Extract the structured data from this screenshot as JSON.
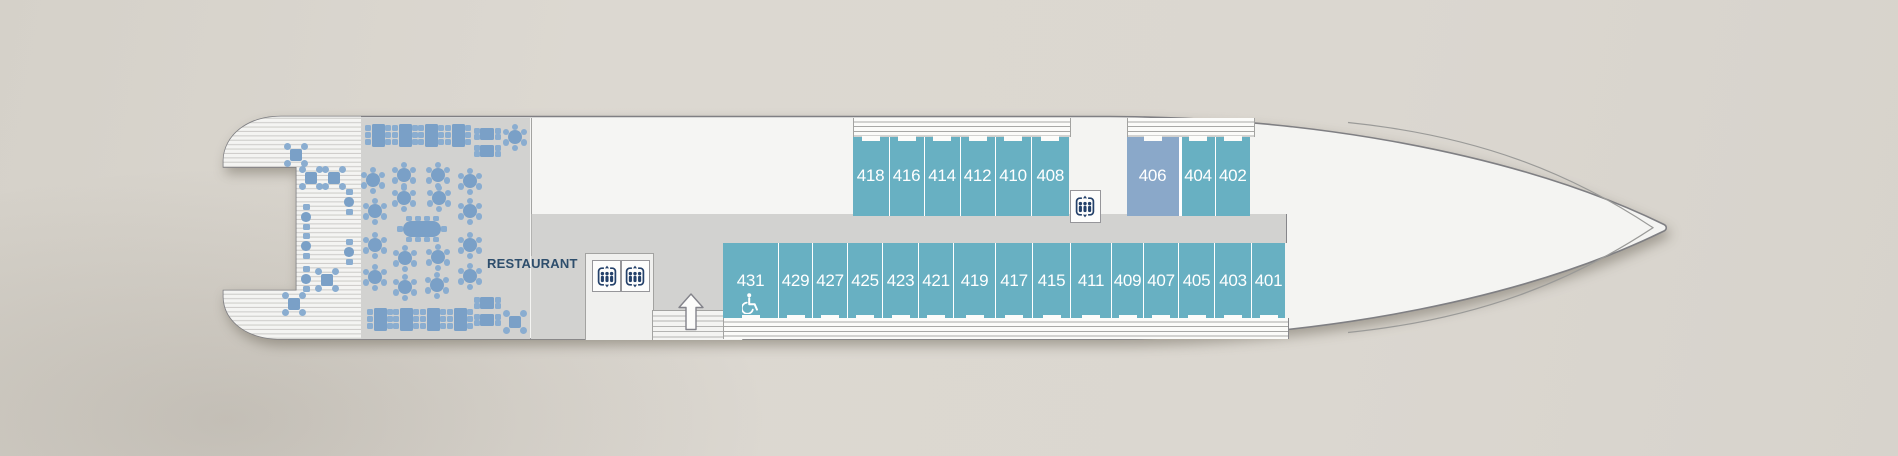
{
  "labels": {
    "restaurant": "RESTAURANT"
  },
  "colors": {
    "background": "#dad6cf",
    "hull_white": "#f4f4f2",
    "hull_outline": "#7f7f83",
    "floor_gray": "#d2d2d0",
    "cabin_teal": "#68b0c2",
    "cabin_blue": "#8aa8c9",
    "table_blue": "#7aa0c7",
    "chair_blue": "#8aadd0",
    "label_navy": "#2e4e6c",
    "icon_navy": "#24416a"
  },
  "icons": [
    {
      "name": "elevator-icon",
      "count": 3
    },
    {
      "name": "wheelchair-icon",
      "count": 1
    },
    {
      "name": "up-arrow-icon",
      "count": 1
    }
  ],
  "cabins": {
    "top_aft_row": [
      {
        "number": "418",
        "w": 36
      },
      {
        "number": "416",
        "w": 35
      },
      {
        "number": "414",
        "w": 36
      },
      {
        "number": "412",
        "w": 35
      },
      {
        "number": "410",
        "w": 36
      },
      {
        "number": "408",
        "w": 38.5
      }
    ],
    "top_forward_row": [
      {
        "number": "406",
        "w": 52,
        "color": "blue"
      },
      {
        "number": "404",
        "w": 36,
        "divider_before": 3
      },
      {
        "number": "402",
        "w": 35.5
      }
    ],
    "bottom_row": [
      {
        "number": "431",
        "w": 55,
        "wheelchair": true
      },
      {
        "number": "429",
        "w": 34
      },
      {
        "number": "427",
        "w": 35
      },
      {
        "number": "425",
        "w": 35
      },
      {
        "number": "423",
        "w": 36
      },
      {
        "number": "421",
        "w": 35
      },
      {
        "number": "419",
        "w": 42
      },
      {
        "number": "417",
        "w": 37
      },
      {
        "number": "415",
        "w": 38
      },
      {
        "number": "411",
        "w": 41
      },
      {
        "number": "409",
        "w": 32
      },
      {
        "number": "407",
        "w": 35
      },
      {
        "number": "405",
        "w": 36
      },
      {
        "number": "403",
        "w": 37
      },
      {
        "number": "401",
        "w": 34
      }
    ]
  },
  "tables": [
    {
      "type": "cross4",
      "x": 296,
      "y": 155
    },
    {
      "type": "cross4",
      "x": 311,
      "y": 178
    },
    {
      "type": "cross4",
      "x": 334,
      "y": 178
    },
    {
      "type": "cross4",
      "x": 327,
      "y": 280
    },
    {
      "type": "cross4",
      "x": 294,
      "y": 304
    },
    {
      "type": "duo2",
      "x": 349,
      "y": 202
    },
    {
      "type": "duo2",
      "x": 306,
      "y": 217
    },
    {
      "type": "duo2",
      "x": 306,
      "y": 246
    },
    {
      "type": "duo2",
      "x": 349,
      "y": 252
    },
    {
      "type": "duo2",
      "x": 306,
      "y": 279
    },
    {
      "type": "rect6",
      "x": 378,
      "y": 135
    },
    {
      "type": "rect6",
      "x": 405,
      "y": 135
    },
    {
      "type": "rect6",
      "x": 431,
      "y": 135
    },
    {
      "type": "rect6",
      "x": 458,
      "y": 135
    },
    {
      "type": "rect4",
      "x": 487,
      "y": 134
    },
    {
      "type": "rect4",
      "x": 487,
      "y": 151
    },
    {
      "type": "round6",
      "x": 515,
      "y": 137
    },
    {
      "type": "round6",
      "x": 373,
      "y": 180
    },
    {
      "type": "round6",
      "x": 404,
      "y": 175
    },
    {
      "type": "round6",
      "x": 438,
      "y": 175
    },
    {
      "type": "round6",
      "x": 470,
      "y": 181
    },
    {
      "type": "round6",
      "x": 404,
      "y": 198
    },
    {
      "type": "round6",
      "x": 439,
      "y": 198
    },
    {
      "type": "round6",
      "x": 375,
      "y": 211
    },
    {
      "type": "round6",
      "x": 470,
      "y": 211
    },
    {
      "type": "oval10",
      "x": 422,
      "y": 229
    },
    {
      "type": "round6",
      "x": 375,
      "y": 245
    },
    {
      "type": "round6",
      "x": 470,
      "y": 245
    },
    {
      "type": "round6",
      "x": 405,
      "y": 258
    },
    {
      "type": "round6",
      "x": 438,
      "y": 257
    },
    {
      "type": "round6",
      "x": 375,
      "y": 277
    },
    {
      "type": "round6",
      "x": 470,
      "y": 276
    },
    {
      "type": "round6",
      "x": 405,
      "y": 287
    },
    {
      "type": "round6",
      "x": 437,
      "y": 285
    },
    {
      "type": "rect6",
      "x": 380,
      "y": 319
    },
    {
      "type": "rect6",
      "x": 406,
      "y": 319
    },
    {
      "type": "rect6",
      "x": 433,
      "y": 319
    },
    {
      "type": "rect6",
      "x": 460,
      "y": 319
    },
    {
      "type": "rect4",
      "x": 487,
      "y": 303
    },
    {
      "type": "rect4",
      "x": 487,
      "y": 320
    },
    {
      "type": "cross4",
      "x": 515,
      "y": 322
    }
  ]
}
